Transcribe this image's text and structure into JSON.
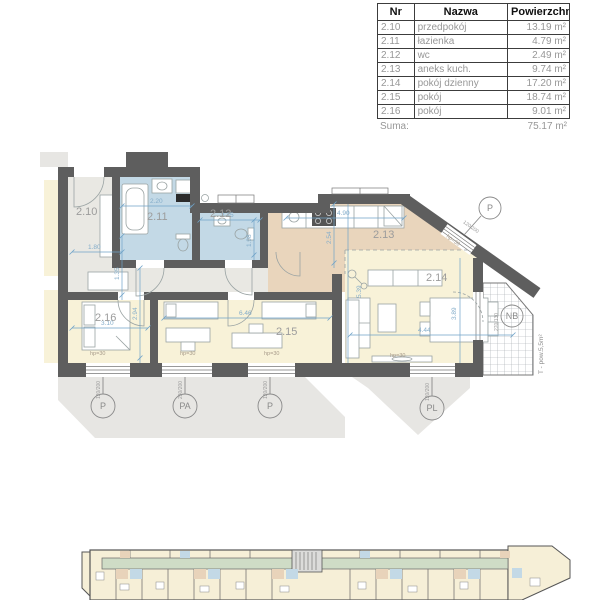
{
  "table": {
    "headers": {
      "nr": "Nr",
      "nazwa": "Nazwa",
      "pow": "Powierzchnia"
    },
    "rows": [
      {
        "nr": "2.10",
        "nazwa": "przedpokój",
        "pow": "13.19 m²"
      },
      {
        "nr": "2.11",
        "nazwa": "łazienka",
        "pow": "4.79 m²"
      },
      {
        "nr": "2.12",
        "nazwa": "wc",
        "pow": "2.49 m²"
      },
      {
        "nr": "2.13",
        "nazwa": "aneks kuch.",
        "pow": "9.74 m²"
      },
      {
        "nr": "2.14",
        "nazwa": "pokój dzienny",
        "pow": "17.20 m²"
      },
      {
        "nr": "2.15",
        "nazwa": "pokój",
        "pow": "18.74 m²"
      },
      {
        "nr": "2.16",
        "nazwa": "pokój",
        "pow": "9.01 m²"
      }
    ],
    "suma_label": "Suma:",
    "suma_value": "75.17 m²"
  },
  "plan": {
    "rooms": {
      "r210": "2.10",
      "r211": "2.11",
      "r212": "2.12",
      "r213": "2.13",
      "r214": "2.14",
      "r215": "2.15",
      "r216": "2.16"
    },
    "dims": {
      "hall_w": "1.80",
      "hall_h": "1.35",
      "bath_w": "2.20",
      "wc_w": "2.25",
      "wc_h": "1.98",
      "kitchen_w": "4.90",
      "kitchen_h": "2.54",
      "living_w": "4.44",
      "living_h1": "5.39",
      "living_h2": "3.89",
      "room15_w": "6.46",
      "room16_w": "3.10",
      "room16_h": "2.94"
    },
    "hp_label": "hp=30",
    "windows": [
      {
        "label": "P",
        "size": "120/200"
      },
      {
        "label": "PA",
        "size": "230/200"
      },
      {
        "label": "P",
        "size": "120/200"
      },
      {
        "label": "PL",
        "size": "120/200"
      },
      {
        "label": "P",
        "size": "120/200"
      },
      {
        "label": "NB",
        "size": "270/130"
      }
    ],
    "terrace_label": "T - pow.5,5m²"
  },
  "colors": {
    "wall": "#5e5e5e",
    "bath_blue": "#c3d9e6",
    "kitchen_tan": "#e9d5bc",
    "room_yellow": "#f8f2d8",
    "hall_gray": "#e9e8e3",
    "dim_blue": "#6fa3c8",
    "corridor_green": "#cfdcc6",
    "shadow_gray": "#e7e6e3"
  }
}
